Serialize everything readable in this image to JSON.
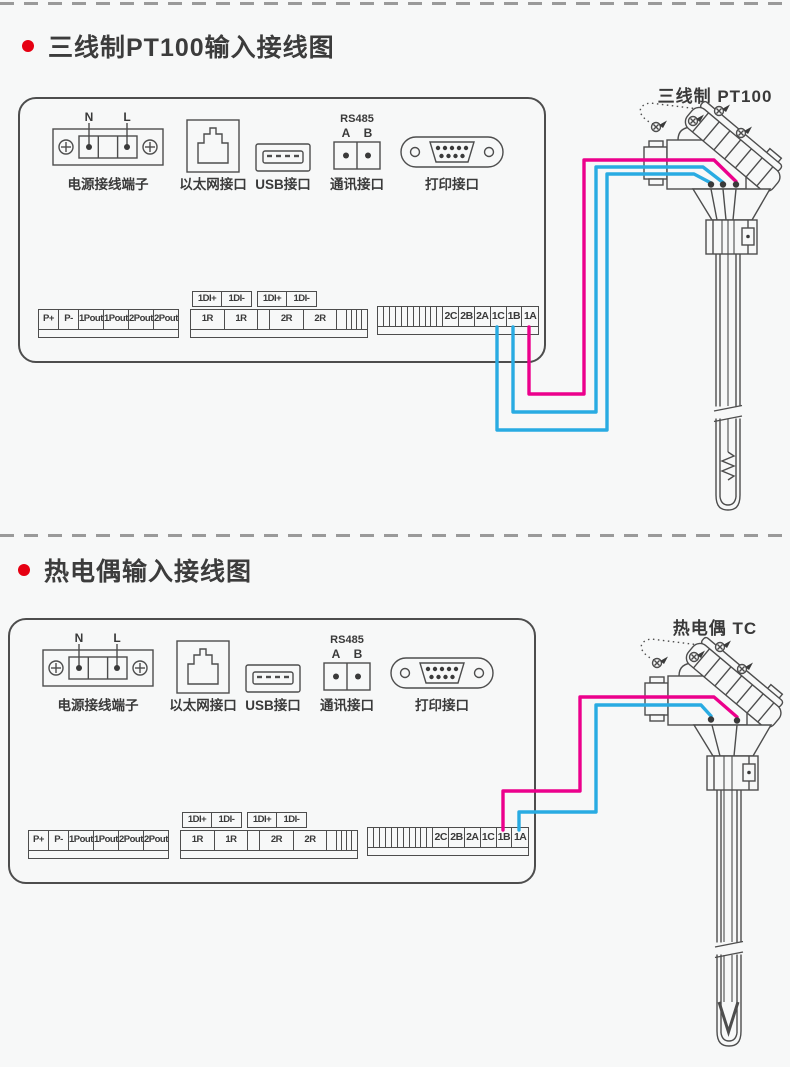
{
  "page": {
    "bg": "#f7f8f8"
  },
  "colors": {
    "wire_pink": "#ec008c",
    "wire_blue": "#29abe2",
    "bullet_red": "#e60012",
    "line_art": "#4d4d4d"
  },
  "sections": [
    {
      "title": "三线制PT100输入接线图",
      "sensor_label": "三线制 PT100",
      "panel": {
        "power": {
          "n": "N",
          "l": "L",
          "label": "电源接线端子"
        },
        "ethernet_label": "以太网接口",
        "usb_label": "USB接口",
        "rs485": {
          "title": "RS485",
          "a": "A",
          "b": "B",
          "label": "通讯接口"
        },
        "printer_label": "打印接口",
        "strips": {
          "power_out": [
            "P+",
            "P-",
            "1Pout+",
            "1Pout-",
            "2Pout+",
            "2Pout-"
          ],
          "di_top": [
            "1DI+",
            "1DI-",
            "1DI+",
            "1DI-"
          ],
          "relay": [
            "1R",
            "1R",
            "2R",
            "2R"
          ],
          "input": [
            "2C",
            "2B",
            "2A",
            "1C",
            "1B",
            "1A"
          ]
        }
      }
    },
    {
      "title": "热电偶输入接线图",
      "sensor_label": "热电偶 TC",
      "panel": {
        "power": {
          "n": "N",
          "l": "L",
          "label": "电源接线端子"
        },
        "ethernet_label": "以太网接口",
        "usb_label": "USB接口",
        "rs485": {
          "title": "RS485",
          "a": "A",
          "b": "B",
          "label": "通讯接口"
        },
        "printer_label": "打印接口",
        "strips": {
          "power_out": [
            "P+",
            "P-",
            "1Pout+",
            "1Pout-",
            "2Pout+",
            "2Pout-"
          ],
          "di_top": [
            "1DI+",
            "1DI-",
            "1DI+",
            "1DI-"
          ],
          "relay": [
            "1R",
            "1R",
            "2R",
            "2R"
          ],
          "input": [
            "2C",
            "2B",
            "2A",
            "1C",
            "1B",
            "1A"
          ]
        }
      }
    }
  ]
}
